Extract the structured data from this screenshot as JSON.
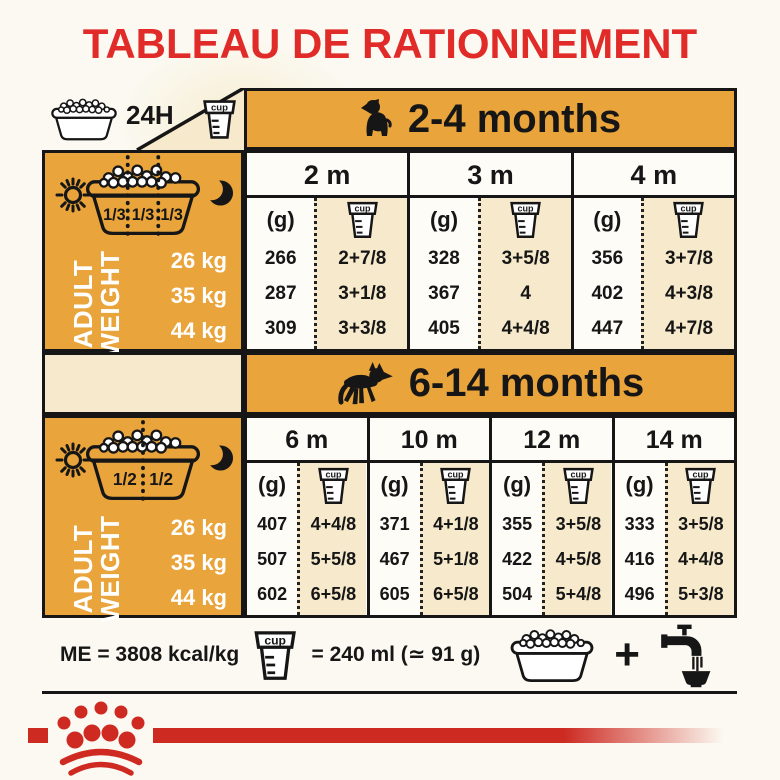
{
  "page": {
    "title": "TABLEAU DE RATIONNEMENT"
  },
  "labels": {
    "hours24": "24H",
    "cup": "cup",
    "grams": "(g)",
    "adult_line1": "ADULT",
    "adult_line2": "WEIGHT",
    "plus": "+"
  },
  "icons": {
    "bowl-kibble-icon": "dog food bowl filled with kibble",
    "measuring-cup-icon": "graduated measuring cup labelled cup",
    "sun-icon": "morning sun",
    "moon-icon": "evening crescent moon",
    "puppy-icon": "sitting puppy silhouette",
    "german-shepherd-icon": "adult german shepherd silhouette",
    "faucet-icon": "tap pouring water into bowl",
    "crown-logo": "royal canin crown emblem"
  },
  "sections": [
    {
      "header": "2-4 months",
      "bowl_fractions": [
        "1/3",
        "1/3",
        "1/3"
      ],
      "weights": [
        "26 kg",
        "35 kg",
        "44 kg"
      ],
      "columns": [
        {
          "label": "2 m",
          "g": [
            "266",
            "287",
            "309"
          ],
          "cups": [
            "2+7/8",
            "3+1/8",
            "3+3/8"
          ]
        },
        {
          "label": "3 m",
          "g": [
            "328",
            "367",
            "405"
          ],
          "cups": [
            "3+5/8",
            "4",
            "4+4/8"
          ]
        },
        {
          "label": "4 m",
          "g": [
            "356",
            "402",
            "447"
          ],
          "cups": [
            "3+7/8",
            "4+3/8",
            "4+7/8"
          ]
        }
      ]
    },
    {
      "header": "6-14 months",
      "bowl_fractions": [
        "1/2",
        "1/2"
      ],
      "weights": [
        "26 kg",
        "35 kg",
        "44 kg"
      ],
      "columns": [
        {
          "label": "6 m",
          "g": [
            "407",
            "507",
            "602"
          ],
          "cups": [
            "4+4/8",
            "5+5/8",
            "6+5/8"
          ]
        },
        {
          "label": "10 m",
          "g": [
            "371",
            "467",
            "605"
          ],
          "cups": [
            "4+1/8",
            "5+1/8",
            "6+5/8"
          ]
        },
        {
          "label": "12 m",
          "g": [
            "355",
            "422",
            "504"
          ],
          "cups": [
            "3+5/8",
            "4+5/8",
            "5+4/8"
          ]
        },
        {
          "label": "14 m",
          "g": [
            "333",
            "416",
            "496"
          ],
          "cups": [
            "3+5/8",
            "4+4/8",
            "5+3/8"
          ]
        }
      ]
    }
  ],
  "footer": {
    "me": "ME = 3808 kcal/kg",
    "cup_equiv": "= 240 ml (≃ 91 g)"
  },
  "colors": {
    "accent_orange": "#E9A43B",
    "cream": "#F6E9CC",
    "brand_red": "#CD2A22",
    "title_red": "#E12B28",
    "ink": "#161616"
  }
}
